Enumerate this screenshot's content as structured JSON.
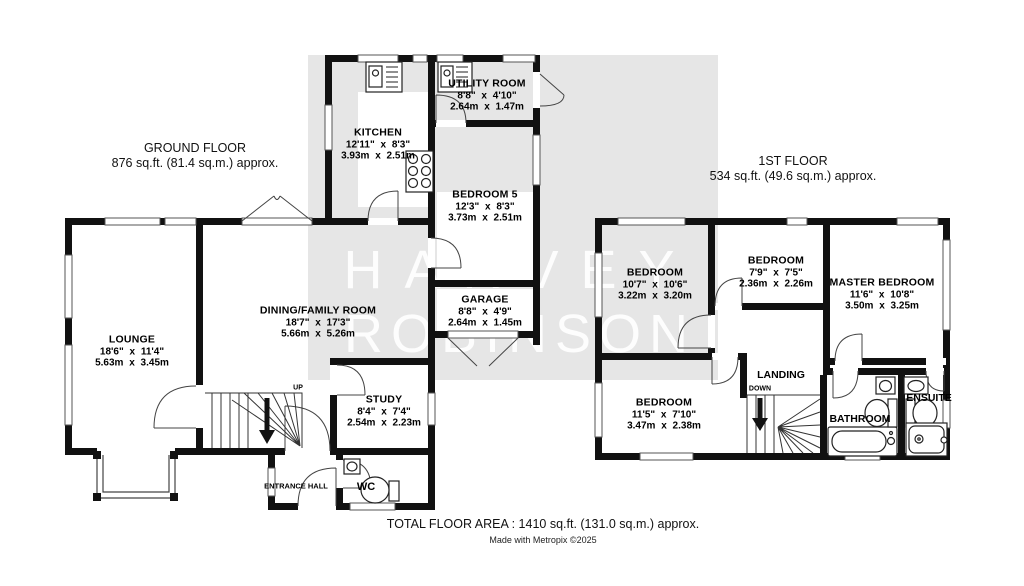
{
  "watermark": {
    "line1": "HARVEY",
    "line2": "ROBINSON"
  },
  "ground_floor": {
    "title": "GROUND FLOOR",
    "area": "876 sq.ft. (81.4 sq.m.) approx.",
    "rooms": {
      "lounge": {
        "name": "LOUNGE",
        "imperial": "18'6\" x 11'4\"",
        "metric": "5.63m x 3.45m"
      },
      "dining_family": {
        "name": "DINING/FAMILY ROOM",
        "imperial": "18'7\" x 17'3\"",
        "metric": "5.66m x 5.26m"
      },
      "kitchen": {
        "name": "KITCHEN",
        "imperial": "12'11\" x 8'3\"",
        "metric": "3.93m x 2.51m"
      },
      "utility": {
        "name": "UTILITY ROOM",
        "imperial": "8'8\" x 4'10\"",
        "metric": "2.64m x 1.47m"
      },
      "bedroom_5": {
        "name": "BEDROOM 5",
        "imperial": "12'3\" x 8'3\"",
        "metric": "3.73m x 2.51m"
      },
      "garage": {
        "name": "GARAGE",
        "imperial": "8'8\" x 4'9\"",
        "metric": "2.64m x 1.45m"
      },
      "study": {
        "name": "STUDY",
        "imperial": "8'4\" x 7'4\"",
        "metric": "2.54m x 2.23m"
      },
      "entrance_hall": {
        "name": "ENTRANCE HALL"
      },
      "wc": {
        "name": "WC"
      }
    },
    "stairs_label": "UP"
  },
  "first_floor": {
    "title": "1ST FLOOR",
    "area": "534 sq.ft. (49.6 sq.m.) approx.",
    "rooms": {
      "bedroom_a": {
        "name": "BEDROOM",
        "imperial": "10'7\" x 10'6\"",
        "metric": "3.22m x 3.20m"
      },
      "bedroom_b": {
        "name": "BEDROOM",
        "imperial": "7'9\" x 7'5\"",
        "metric": "2.36m x 2.26m"
      },
      "master_bedroom": {
        "name": "MASTER BEDROOM",
        "imperial": "11'6\" x 10'8\"",
        "metric": "3.50m x 3.25m"
      },
      "bedroom_c": {
        "name": "BEDROOM",
        "imperial": "11'5\" x 7'10\"",
        "metric": "3.47m x 2.38m"
      },
      "landing": {
        "name": "LANDING"
      },
      "bathroom": {
        "name": "BATHROOM"
      },
      "ensuite": {
        "name": "ENSUITE"
      }
    },
    "stairs_label": "DOWN"
  },
  "footer": {
    "total_area": "TOTAL FLOOR AREA : 1410 sq.ft. (131.0 sq.m.) approx.",
    "credit": "Made with Metropix ©2025"
  },
  "colors": {
    "wall": "#111111",
    "watermark_band": "#e6e6e6",
    "watermark_text": "#ffffff",
    "thin_line": "#555555"
  }
}
